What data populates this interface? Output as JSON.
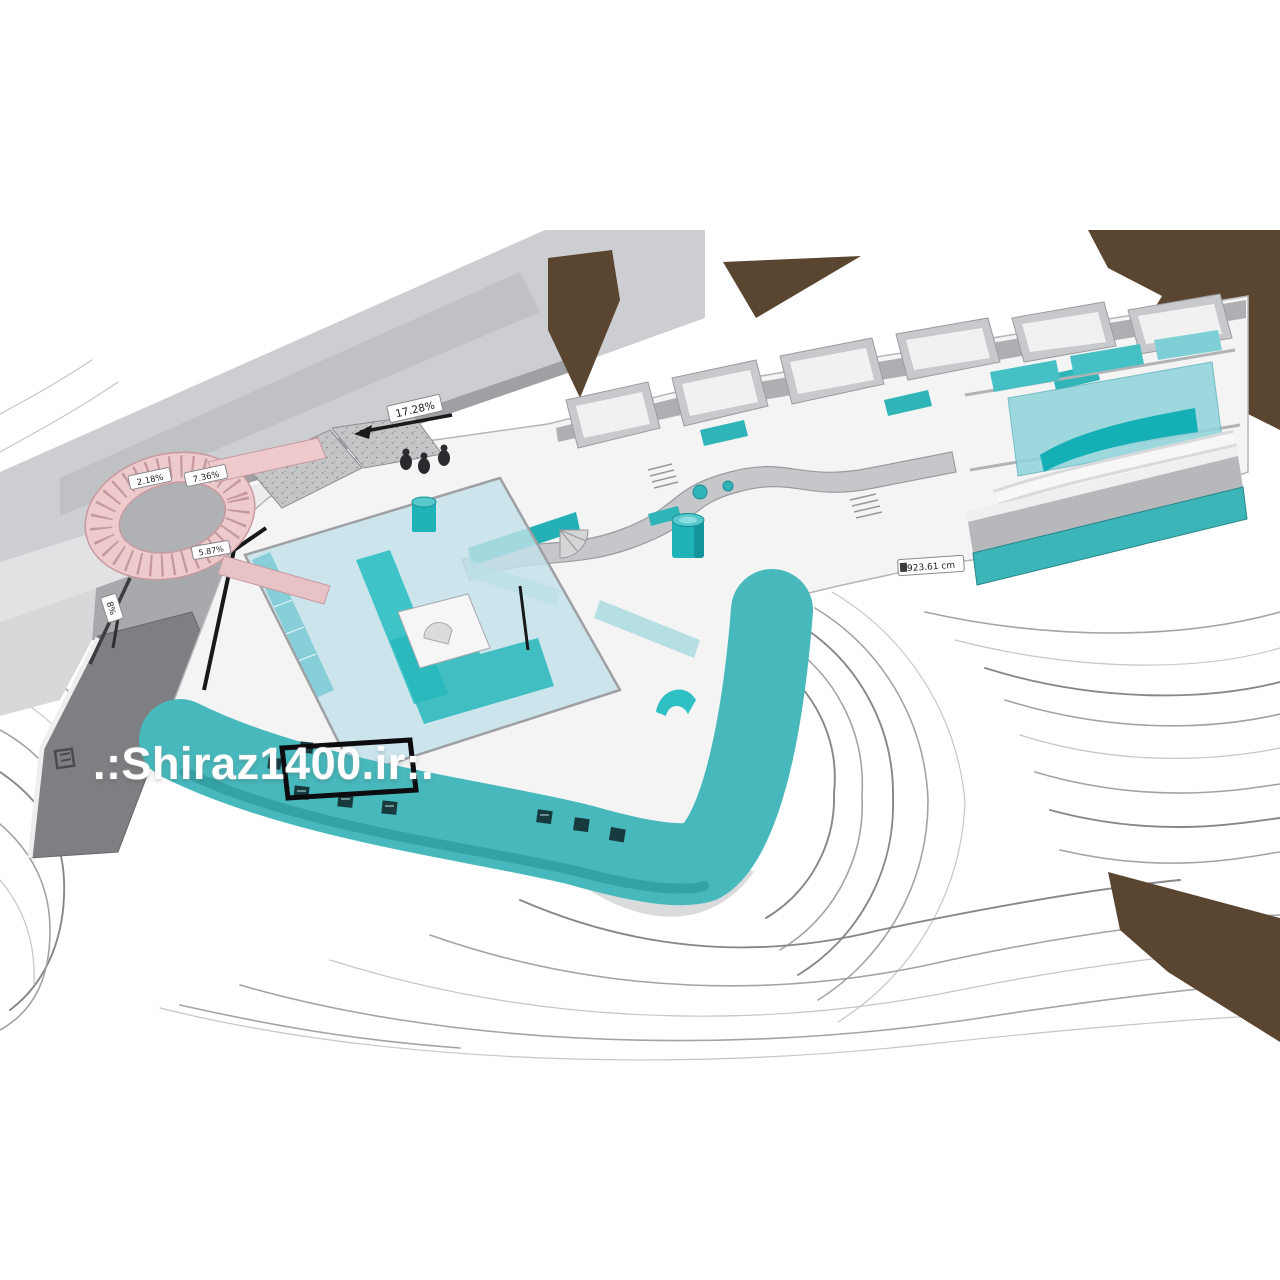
{
  "watermark": {
    "text": ".:Shiraz1400.ir:."
  },
  "labels": {
    "road_slope": "17.28%",
    "ramp_upper_left": "2.18%",
    "ramp_upper_right": "7.36%",
    "ramp_lower": "5.87%",
    "height_marker": "923.61 cm",
    "grade_marker": "8%"
  },
  "colors": {
    "teal_wall": "#47b9bd",
    "pool_teal": "#1fb3b7",
    "glass_cyan": "#b9dfe8",
    "ramp_pink": "#eecacd",
    "terrain_brown": "#5a4531",
    "road_gray": "#cdced1",
    "dark_road_gray": "#7e7f82",
    "contour_gray": "#9c9c9e"
  }
}
